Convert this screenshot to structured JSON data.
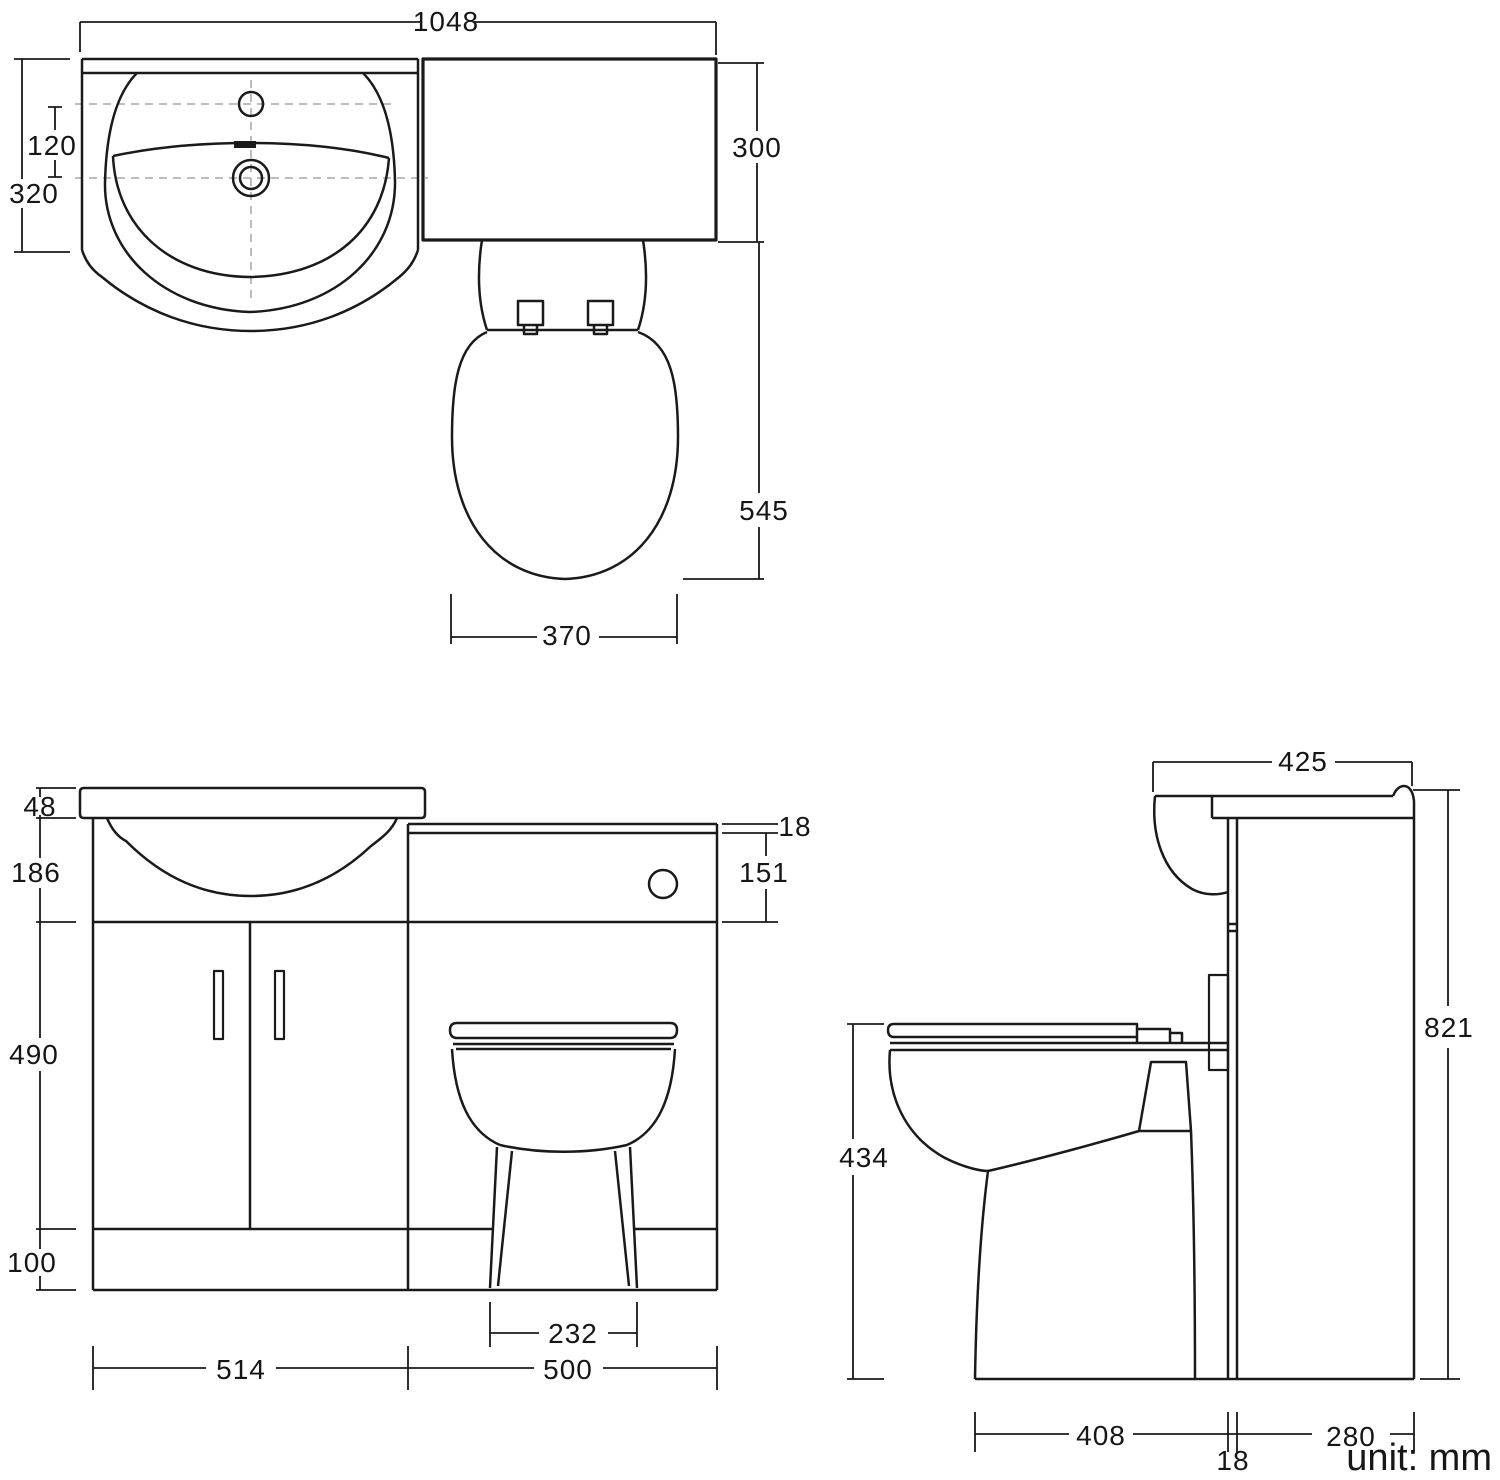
{
  "note": "unit: mm",
  "dims": {
    "plan_width": "1048",
    "plan_tap_offset": "120",
    "plan_basin_depth": "320",
    "plan_wc_depth": "300",
    "plan_wc_projection": "545",
    "plan_pan_width": "370",
    "front_worktop_thickness": "48",
    "front_basin_height": "186",
    "front_door_height": "490",
    "front_plinth_height": "100",
    "front_wc_top_thickness": "18",
    "front_wc_panel_height": "151",
    "front_pan_base_width": "232",
    "front_vanity_width": "514",
    "front_wc_width": "500",
    "side_overall_depth": "425",
    "side_overall_height": "821",
    "side_pan_height": "434",
    "side_pan_depth": "408",
    "side_panel_thickness": "18",
    "side_cabinet_depth": "280"
  }
}
